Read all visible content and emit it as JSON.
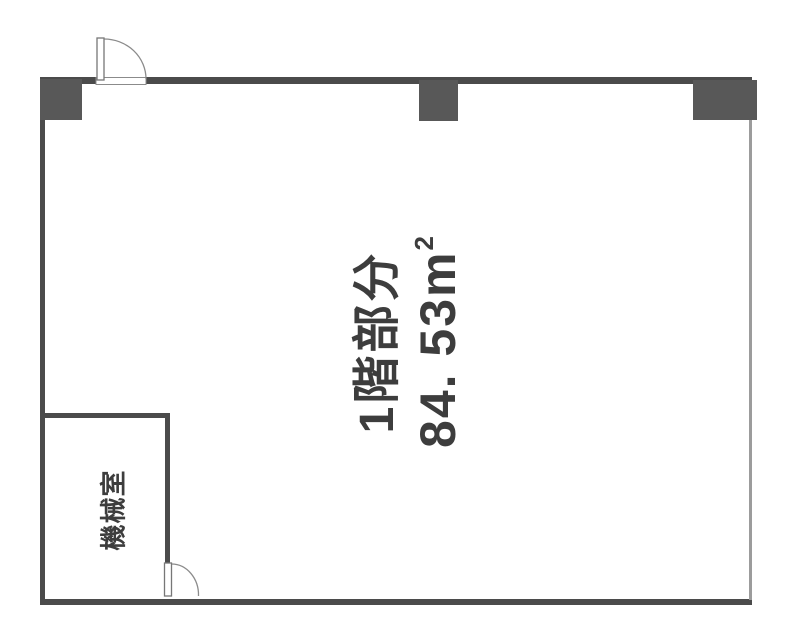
{
  "rooms": {
    "main": {
      "name": "1階部分",
      "area_value": "84. 53",
      "area_unit": "m",
      "area_exponent": "2"
    },
    "machine": {
      "name": "機械室"
    }
  },
  "colors": {
    "wall": "#4b4b4b",
    "pillar": "#585858",
    "thinwall": "#9c9c9c",
    "doorline": "#8b8b8b",
    "text": "#3d3d3d",
    "bg": "#ffffff"
  }
}
